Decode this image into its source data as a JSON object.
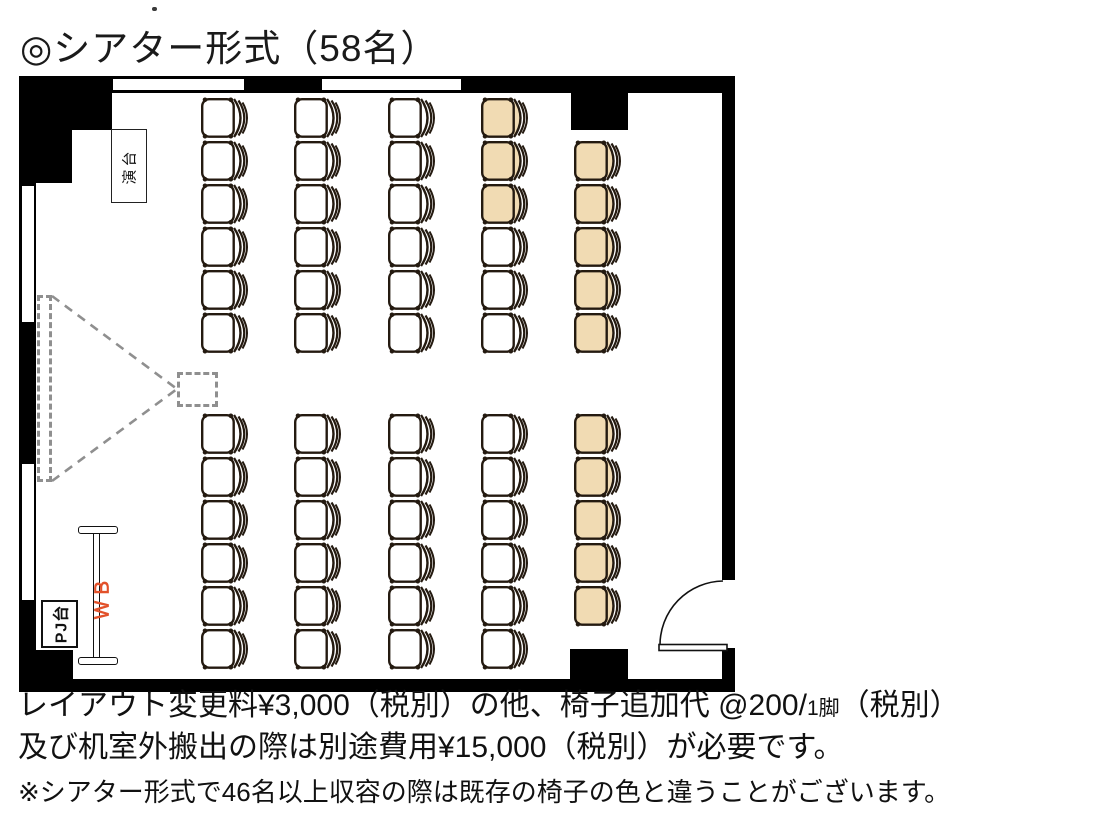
{
  "title": "◎シアター形式（58名）",
  "floorplan": {
    "podium_label": "演台",
    "projector_stand_label": "PJ台",
    "whiteboard_label": "ＷＢ",
    "colors": {
      "wall": "#000000",
      "chair_standard": "#ffffff",
      "chair_additional": "#f1dbb3",
      "chair_outline": "#241a10",
      "projection_dash": "#8f8f8f",
      "whiteboard_label_color": "#e2512a"
    },
    "seating": {
      "capacity_in_title": "58名",
      "column_x": [
        200,
        293,
        387,
        480,
        573
      ],
      "blocks": [
        {
          "name": "upper",
          "row_y": [
            97,
            140,
            183,
            226,
            269,
            312
          ],
          "columns": [
            [
              "w",
              "w",
              "w",
              "w",
              "w",
              "w"
            ],
            [
              "w",
              "w",
              "w",
              "w",
              "w",
              "w"
            ],
            [
              "w",
              "w",
              "w",
              "w",
              "w",
              "w"
            ],
            [
              "b",
              "b",
              "b",
              "w",
              "w",
              "w"
            ],
            [
              null,
              "b",
              "b",
              "b",
              "b",
              "b"
            ]
          ]
        },
        {
          "name": "lower",
          "row_y": [
            413,
            456,
            499,
            542,
            585,
            628
          ],
          "columns": [
            [
              "w",
              "w",
              "w",
              "w",
              "w",
              "w"
            ],
            [
              "w",
              "w",
              "w",
              "w",
              "w",
              "w"
            ],
            [
              "w",
              "w",
              "w",
              "w",
              "w",
              "w"
            ],
            [
              "w",
              "w",
              "w",
              "w",
              "w",
              "w"
            ],
            [
              "b",
              "b",
              "b",
              "b",
              "b",
              null
            ]
          ]
        }
      ]
    }
  },
  "notes": {
    "line1_main": "レイアウト変更料¥3,000（税別）の他、椅子追加代 @200/",
    "line1_small": "1脚",
    "line1_tail": "（税別）",
    "line2": "及び机室外搬出の際は別途費用¥15,000（税別）が必要です。",
    "line3": "※シアター形式で46名以上収容の際は既存の椅子の色と違うことがございます。"
  }
}
